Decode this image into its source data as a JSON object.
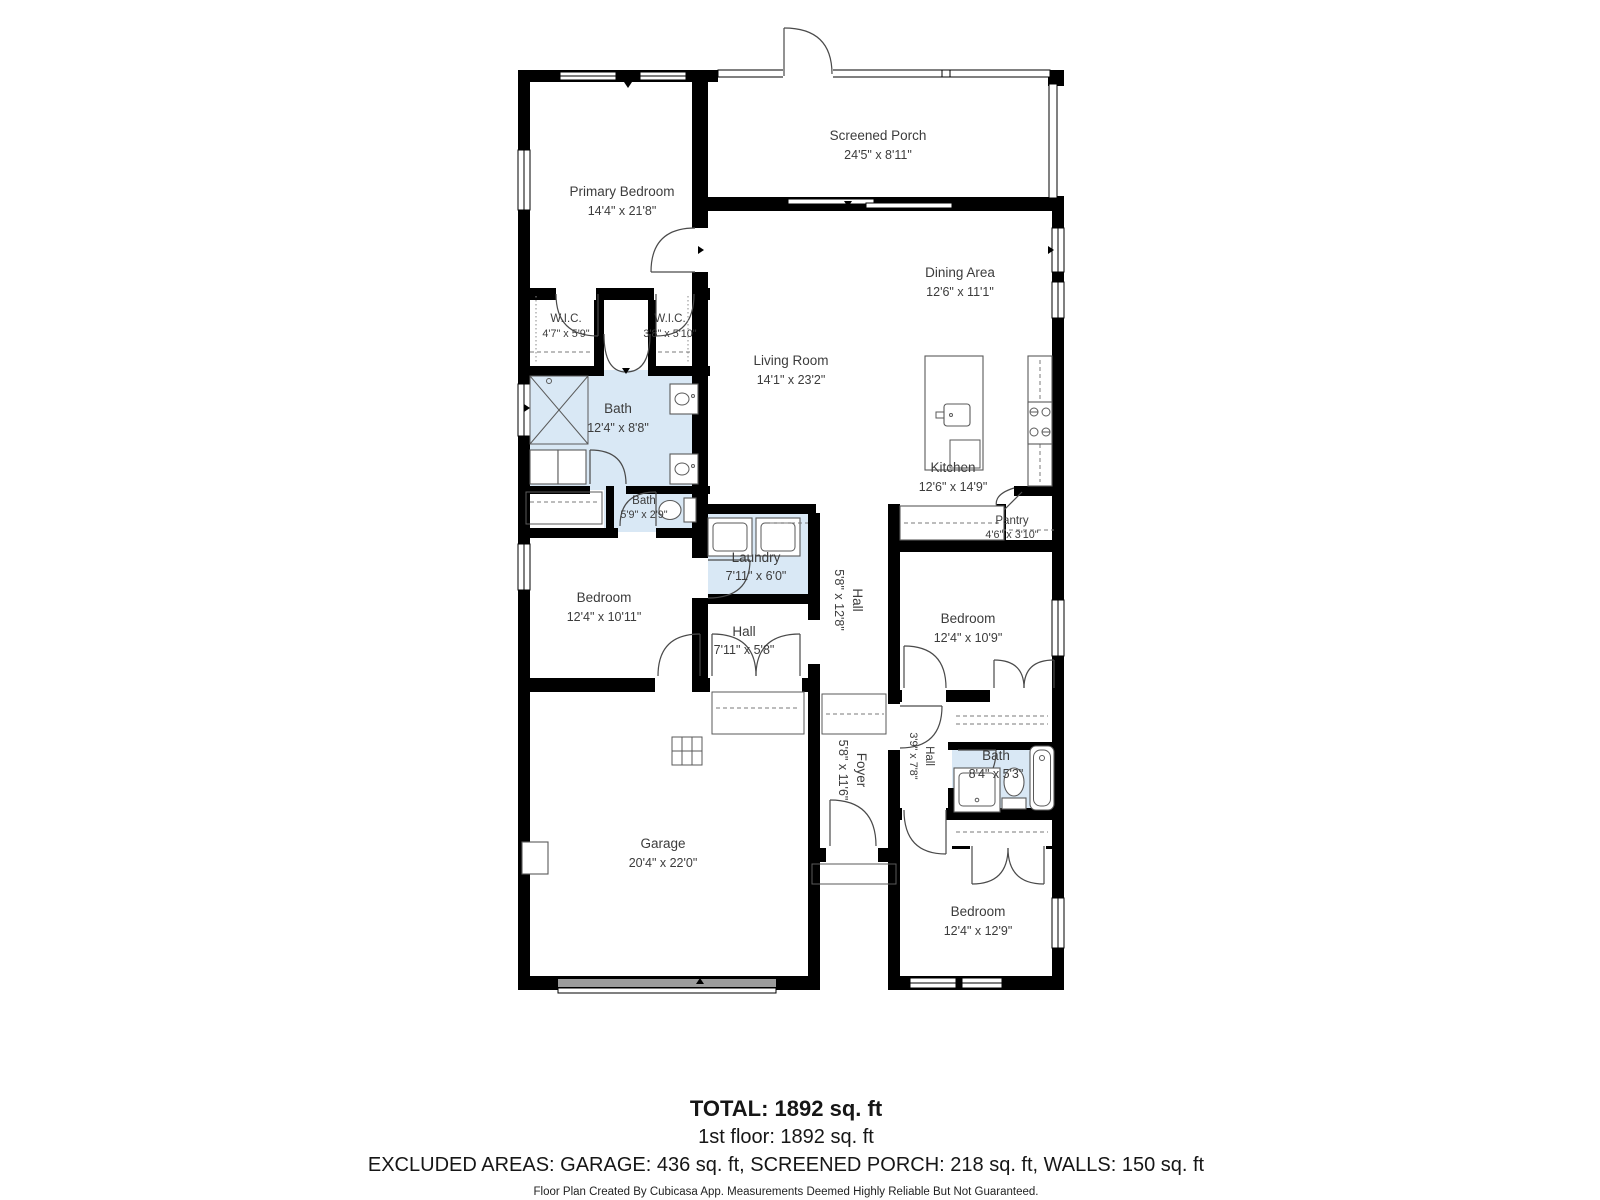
{
  "colors": {
    "wall": "#000000",
    "wet_room_fill": "#d9e8f5",
    "label_text": "#3c3c3c",
    "garage_door": "#9c9c9c",
    "background": "#ffffff"
  },
  "rooms": [
    {
      "id": "primary-bedroom",
      "name": "Primary Bedroom",
      "dims": "14'4\" x 21'8\""
    },
    {
      "id": "screened-porch",
      "name": "Screened Porch",
      "dims": "24'5\" x 8'11\""
    },
    {
      "id": "dining-area",
      "name": "Dining Area",
      "dims": "12'6\" x 11'1\""
    },
    {
      "id": "living-room",
      "name": "Living Room",
      "dims": "14'1\" x 23'2\""
    },
    {
      "id": "wic-left",
      "name": "W.I.C.",
      "dims": "4'7\" x 5'9\""
    },
    {
      "id": "wic-right",
      "name": "W.I.C.",
      "dims": "3'8\" x 5'10\""
    },
    {
      "id": "bath-primary",
      "name": "Bath",
      "dims": "12'4\" x 8'8\""
    },
    {
      "id": "bath-small",
      "name": "Bath",
      "dims": "5'9\" x 2'9\""
    },
    {
      "id": "laundry",
      "name": "Laundry",
      "dims": "7'11\" x 6'0\""
    },
    {
      "id": "kitchen",
      "name": "Kitchen",
      "dims": "12'6\" x 14'9\""
    },
    {
      "id": "pantry",
      "name": "Pantry",
      "dims": "4'6\" x 3'10\""
    },
    {
      "id": "hall-main",
      "name": "Hall",
      "dims": "5'8\" x 12'8\""
    },
    {
      "id": "bedroom-left",
      "name": "Bedroom",
      "dims": "12'4\" x 10'11\""
    },
    {
      "id": "hall-small",
      "name": "Hall",
      "dims": "7'11\" x 5'8\""
    },
    {
      "id": "bedroom-right",
      "name": "Bedroom",
      "dims": "12'4\" x 10'9\""
    },
    {
      "id": "foyer",
      "name": "Foyer",
      "dims": "5'8\" x 11'6\""
    },
    {
      "id": "hall-rear",
      "name": "Hall",
      "dims": "3'9\" x 7'8\""
    },
    {
      "id": "bath-rear",
      "name": "Bath",
      "dims": "8'4\" x 5'3\""
    },
    {
      "id": "garage",
      "name": "Garage",
      "dims": "20'4\" x 22'0\""
    },
    {
      "id": "bedroom-bottom",
      "name": "Bedroom",
      "dims": "12'4\" x 12'9\""
    }
  ],
  "footer": {
    "total": "TOTAL: 1892 sq. ft",
    "floor": "1st floor: 1892 sq. ft",
    "excluded": "EXCLUDED AREAS: GARAGE: 436 sq. ft, SCREENED PORCH: 218 sq. ft, WALLS: 150 sq. ft",
    "disclaimer": "Floor Plan Created By Cubicasa App. Measurements Deemed Highly Reliable But Not Guaranteed."
  }
}
